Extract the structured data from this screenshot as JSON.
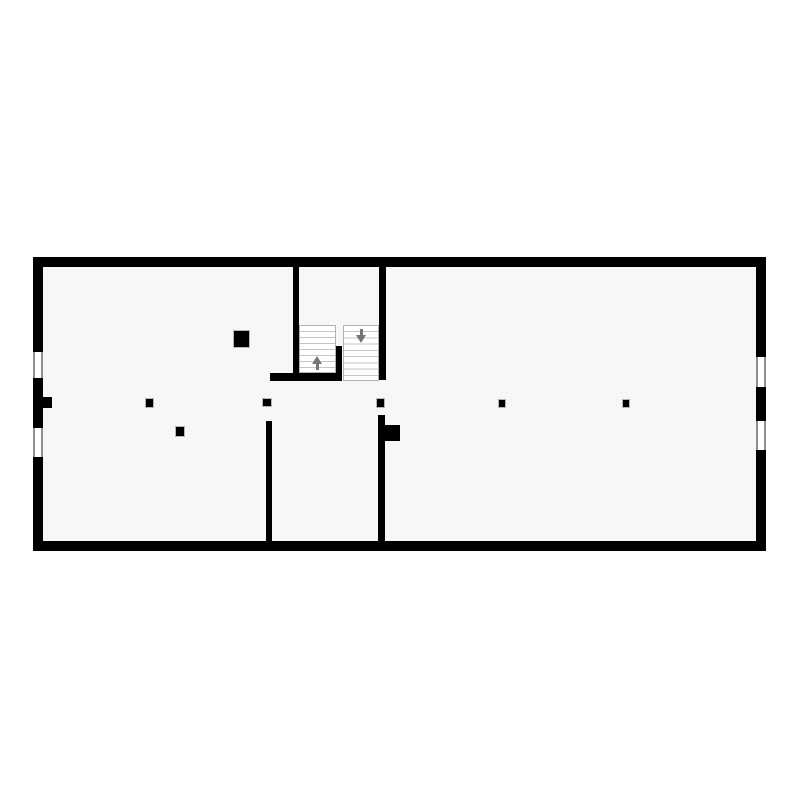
{
  "floorplan": {
    "description": "single-storey rectangular floor plan with central staircase",
    "canvas": {
      "width": 800,
      "height": 800,
      "background": "#ffffff"
    },
    "colors": {
      "wall": "#000000",
      "floor": "#f7f7f8",
      "window_line": "#8f8f8f",
      "window_fill": "#ffffff",
      "tread_line": "#c6c6c6",
      "flight_border": "#b2b2b2",
      "arrow": "#757575"
    },
    "floor_area": {
      "name": "floor-area",
      "x": 43,
      "y": 267,
      "w": 713,
      "h": 274
    },
    "exterior_walls": [
      {
        "name": "exterior-wall-top",
        "x": 33,
        "y": 257,
        "w": 733,
        "h": 10
      },
      {
        "name": "exterior-wall-bottom",
        "x": 33,
        "y": 541,
        "w": 733,
        "h": 10
      },
      {
        "name": "exterior-wall-left",
        "x": 33,
        "y": 257,
        "w": 10,
        "h": 294
      },
      {
        "name": "exterior-wall-right",
        "x": 756,
        "y": 257,
        "w": 10,
        "h": 294
      }
    ],
    "windows": [
      {
        "name": "window-left-upper",
        "x": 33,
        "y": 352,
        "w": 10,
        "h": 26,
        "orientation": "vertical"
      },
      {
        "name": "window-left-lower",
        "x": 33,
        "y": 428,
        "w": 10,
        "h": 29,
        "orientation": "vertical"
      },
      {
        "name": "window-right-upper",
        "x": 756,
        "y": 357,
        "w": 10,
        "h": 30,
        "orientation": "vertical"
      },
      {
        "name": "window-right-lower",
        "x": 756,
        "y": 421,
        "w": 10,
        "h": 29,
        "orientation": "vertical"
      }
    ],
    "interior_walls": [
      {
        "name": "stair-wall-left",
        "x": 293,
        "y": 267,
        "w": 6,
        "h": 114
      },
      {
        "name": "stair-wall-right",
        "x": 379,
        "y": 267,
        "w": 7,
        "h": 113
      },
      {
        "name": "stair-wall-bottom",
        "x": 270,
        "y": 373,
        "w": 72,
        "h": 8
      },
      {
        "name": "stair-divider-wall",
        "x": 336,
        "y": 346,
        "w": 6,
        "h": 35
      },
      {
        "name": "partition-wall-left",
        "x": 266,
        "y": 421,
        "w": 6,
        "h": 120
      },
      {
        "name": "partition-wall-right",
        "x": 378,
        "y": 415,
        "w": 7,
        "h": 126
      },
      {
        "name": "partition-right-pier",
        "x": 385,
        "y": 425,
        "w": 15,
        "h": 16
      },
      {
        "name": "left-wall-pilaster",
        "x": 43,
        "y": 397,
        "w": 9,
        "h": 11
      }
    ],
    "columns": [
      {
        "name": "column-large",
        "x": 233,
        "y": 330,
        "w": 17,
        "h": 18
      },
      {
        "name": "column-medium",
        "x": 175,
        "y": 426,
        "w": 10,
        "h": 11
      },
      {
        "name": "column-row-1",
        "x": 145,
        "y": 398,
        "w": 9,
        "h": 10
      },
      {
        "name": "column-row-2",
        "x": 262,
        "y": 398,
        "w": 10,
        "h": 9
      },
      {
        "name": "column-row-3",
        "x": 376,
        "y": 398,
        "w": 9,
        "h": 10
      },
      {
        "name": "column-row-4",
        "x": 498,
        "y": 399,
        "w": 8,
        "h": 9
      },
      {
        "name": "column-row-5",
        "x": 622,
        "y": 399,
        "w": 8,
        "h": 9
      }
    ],
    "stairs": {
      "flights": [
        {
          "name": "stair-flight-up",
          "x": 299,
          "y": 325,
          "w": 37,
          "h": 48,
          "steps": 8
        },
        {
          "name": "stair-flight-down",
          "x": 343,
          "y": 325,
          "w": 36,
          "h": 56,
          "steps": 9
        }
      ],
      "arrows": [
        {
          "name": "stair-arrow-up",
          "x": 311,
          "y": 355,
          "w": 12,
          "h": 15,
          "direction": "up"
        },
        {
          "name": "stair-arrow-down",
          "x": 355,
          "y": 328,
          "w": 12,
          "h": 15,
          "direction": "down"
        }
      ]
    }
  }
}
